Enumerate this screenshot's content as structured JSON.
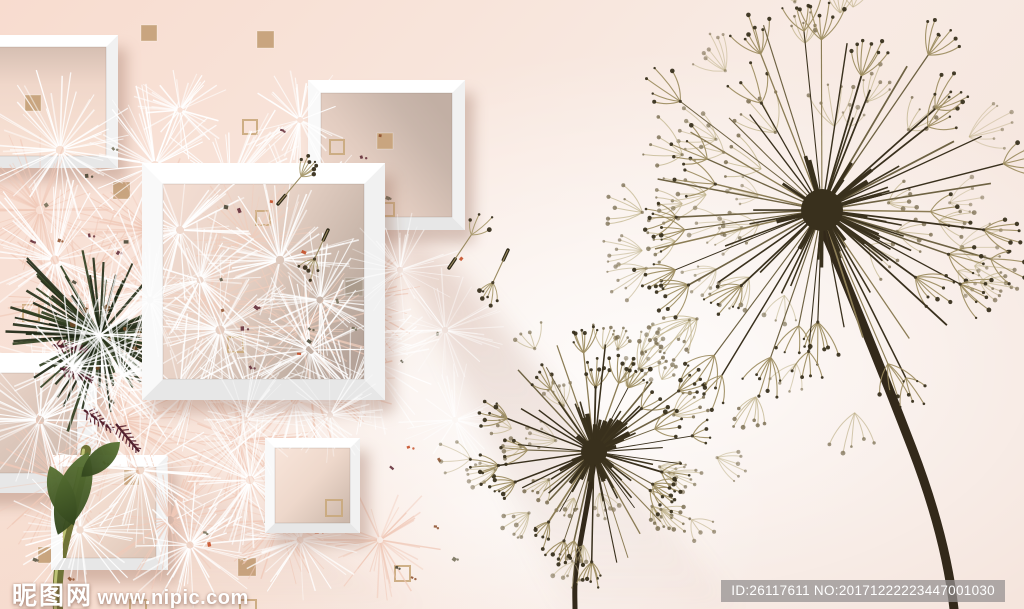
{
  "watermark": {
    "site_name": "昵图网",
    "site_url": "www.nipic.com",
    "badge_text": "ID:26117611 NO:20171222223447001030"
  },
  "palette": {
    "bg_pink": "#f8ddd0",
    "bg_light": "#f7e9e2",
    "frame_white": "#fdfdfd",
    "square_fill": "#c9a57f",
    "square_fill_muted": "#ab9c8d",
    "square_outline": "#c9a87c",
    "dandelion_dark": "#39301d",
    "dandelion_mid": "#6e6243",
    "dandelion_light": "#8b7c55",
    "tuft_light": "#bfb28a",
    "dark_flower_green": "#2c3a1e",
    "leaf_green": "#4d662b",
    "stem_green": "#8d9347",
    "stem_highlight": "#c6cb7c",
    "maroon": "#5c2430",
    "shadow": "#9c7260"
  },
  "scene": {
    "frames": [
      {
        "id": "frame-top-right",
        "x": 308,
        "y": 80,
        "w": 157,
        "h": 150,
        "b": 13,
        "interior": "gBrown"
      },
      {
        "id": "frame-top-left",
        "x": -34,
        "y": 35,
        "w": 152,
        "h": 133,
        "b": 12,
        "interior": "gPinkTop"
      },
      {
        "id": "frame-left-mid",
        "x": -60,
        "y": 353,
        "w": 157,
        "h": 140,
        "b": 20,
        "interior": "gGray",
        "ledge": {
          "x": 95,
          "y": 353,
          "w": 60,
          "h": 20
        }
      },
      {
        "id": "frame-bottom-left",
        "x": 51,
        "y": 455,
        "w": 117,
        "h": 115,
        "b": 12,
        "interior": "gPink"
      },
      {
        "id": "frame-bottom-mid",
        "x": 265,
        "y": 438,
        "w": 95,
        "h": 95,
        "b": 10,
        "interior": "gPink2"
      },
      {
        "id": "frame-middle",
        "x": 142,
        "y": 163,
        "w": 243,
        "h": 237,
        "b": 21,
        "interior": "gBig"
      }
    ],
    "squares_filled_wall": [
      [
        141,
        25,
        16
      ],
      [
        257,
        31,
        17
      ],
      [
        113,
        182,
        17
      ],
      [
        38,
        547,
        16
      ],
      [
        238,
        558,
        18
      ]
    ],
    "squares_outline_wall": [
      [
        243,
        120,
        14
      ],
      [
        23,
        305,
        16
      ],
      [
        38,
        457,
        15
      ],
      [
        395,
        566,
        15
      ],
      [
        130,
        600,
        16
      ],
      [
        240,
        600,
        16
      ]
    ],
    "squares_in_frames": {
      "top_right_filled": [
        [
          377,
          133,
          16
        ]
      ],
      "top_right_outline": [
        [
          330,
          140,
          14
        ],
        [
          381,
          203,
          13
        ]
      ],
      "top_left_filled": [
        [
          25,
          95,
          16
        ]
      ],
      "bottom_left_filled": [
        [
          124,
          470,
          15
        ]
      ],
      "bottom_mid_outline": [
        [
          326,
          500,
          16
        ]
      ],
      "middle_outline": [
        [
          256,
          211,
          14
        ],
        [
          228,
          337,
          15
        ]
      ],
      "middle_filled_muted": [
        [
          345,
          278,
          18
        ]
      ]
    },
    "floating_seeds": [
      {
        "x": 278,
        "y": 204,
        "angle": -50,
        "len": 36
      },
      {
        "x": 328,
        "y": 230,
        "angle": 115,
        "len": 32
      },
      {
        "x": 449,
        "y": 268,
        "angle": -56,
        "len": 40
      },
      {
        "x": 508,
        "y": 250,
        "angle": 115,
        "len": 36
      }
    ],
    "dandelions": [
      {
        "id": "dandelion-small",
        "cx": 594,
        "cy": 452,
        "head_r": 116,
        "core_r": 13,
        "spines": 40,
        "loose_tufts": 26,
        "tuft_size": 24,
        "stem_w": 5,
        "stem": "M594,462 C588,505 580,540 576,570 C574,585 575,598 575,609"
      },
      {
        "id": "dandelion-large",
        "cx": 822,
        "cy": 210,
        "head_r": 195,
        "core_r": 21,
        "spines": 48,
        "loose_tufts": 42,
        "tuft_size": 34,
        "stem_w": 9,
        "stem": "M823,228 C845,280 882,370 912,448 C932,500 948,556 954,609"
      }
    ],
    "dark_flower": {
      "cx": 100,
      "cy": 335,
      "r": 108,
      "stem": "M86,450 C80,492 64,534 59,570 C57,588 57,599 58,609",
      "leaves": [
        {
          "x": 88,
          "y": 452,
          "rot": 20,
          "w": 34,
          "h": 88
        },
        {
          "x": 50,
          "y": 466,
          "rot": -22,
          "w": 26,
          "h": 64
        },
        {
          "x": 120,
          "y": 442,
          "rot": 48,
          "w": 22,
          "h": 52
        }
      ],
      "feathers": [
        [
          60,
          368,
          -70
        ],
        [
          84,
          410,
          -55
        ],
        [
          52,
          345,
          -82
        ],
        [
          116,
          424,
          -40
        ]
      ]
    },
    "fluff": {
      "pink": [
        [
          40,
          210,
          85
        ],
        [
          150,
          230,
          88
        ],
        [
          260,
          250,
          88
        ],
        [
          350,
          300,
          82
        ],
        [
          80,
          300,
          92
        ],
        [
          200,
          340,
          92
        ],
        [
          310,
          380,
          86
        ],
        [
          120,
          420,
          92
        ],
        [
          240,
          440,
          86
        ],
        [
          60,
          480,
          82
        ],
        [
          170,
          520,
          80
        ],
        [
          280,
          520,
          72
        ],
        [
          380,
          540,
          62
        ]
      ],
      "white": [
        [
          60,
          150,
          85
        ],
        [
          155,
          165,
          82
        ],
        [
          230,
          185,
          88
        ],
        [
          300,
          215,
          85
        ],
        [
          55,
          260,
          90
        ],
        [
          150,
          290,
          95
        ],
        [
          250,
          300,
          90
        ],
        [
          330,
          330,
          85
        ],
        [
          90,
          355,
          95
        ],
        [
          195,
          385,
          95
        ],
        [
          295,
          400,
          88
        ],
        [
          370,
          360,
          80
        ],
        [
          40,
          420,
          85
        ],
        [
          140,
          470,
          88
        ],
        [
          250,
          480,
          84
        ],
        [
          80,
          530,
          75
        ],
        [
          190,
          545,
          72
        ],
        [
          300,
          540,
          70
        ],
        [
          180,
          110,
          55
        ],
        [
          300,
          120,
          60
        ]
      ],
      "inner_pink": [
        [
          210,
          300,
          80
        ],
        [
          300,
          330,
          80
        ],
        [
          250,
          240,
          70
        ]
      ],
      "inner_white": [
        [
          180,
          230,
          80
        ],
        [
          280,
          260,
          85
        ],
        [
          220,
          330,
          90
        ],
        [
          310,
          350,
          85
        ],
        [
          180,
          390,
          80
        ],
        [
          350,
          390,
          75
        ],
        [
          250,
          395,
          75
        ],
        [
          320,
          300,
          70
        ],
        [
          200,
          280,
          70
        ]
      ],
      "post": [
        [
          150,
          300,
          70
        ],
        [
          245,
          420,
          68
        ],
        [
          330,
          415,
          60
        ],
        [
          400,
          270,
          62
        ],
        [
          445,
          330,
          64
        ],
        [
          455,
          420,
          60
        ]
      ]
    },
    "speck_count_wall": 42,
    "speck_count_inner": 14
  }
}
